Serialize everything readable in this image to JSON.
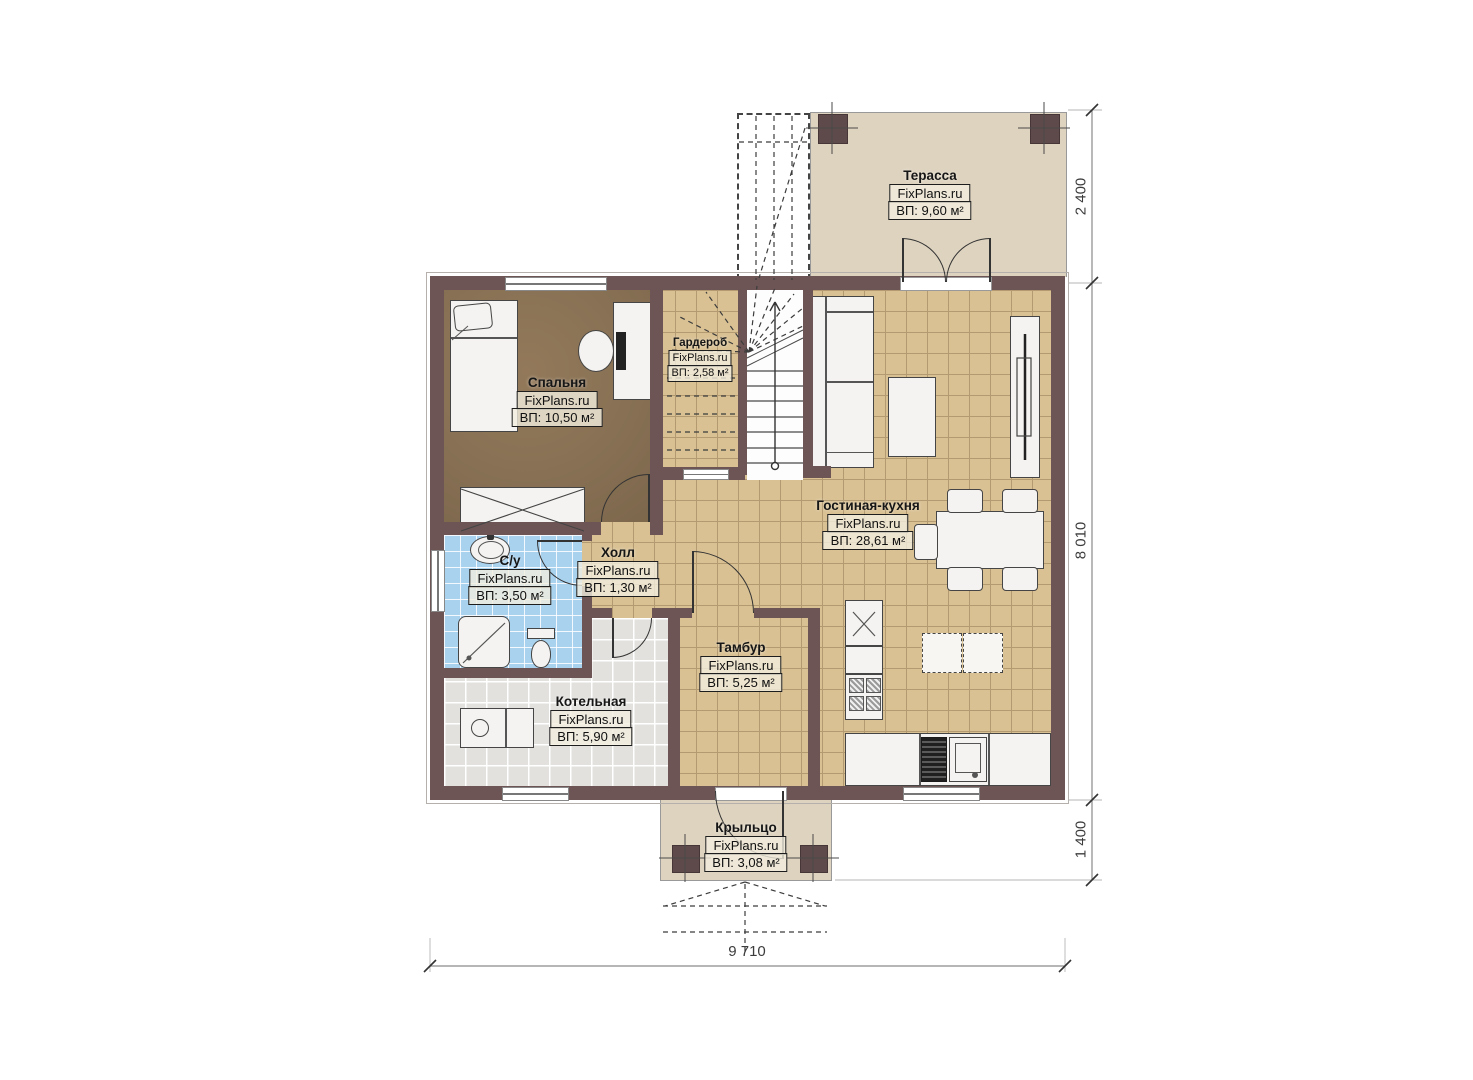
{
  "watermark": "FixPlans.ru",
  "rooms": {
    "terrace": {
      "name": "Терасса",
      "area": "ВП: 9,60 м²"
    },
    "bedroom": {
      "name": "Спальня",
      "area": "ВП: 10,50 м²"
    },
    "wardrobe": {
      "name": "Гардероб",
      "area": "ВП: 2,58 м²"
    },
    "living_kitchen": {
      "name": "Гостиная-кухня",
      "area": "ВП: 28,61 м²"
    },
    "hall": {
      "name": "Холл",
      "area": "ВП: 1,30 м²"
    },
    "bathroom": {
      "name": "С/у",
      "area": "ВП: 3,50 м²"
    },
    "boiler": {
      "name": "Котельная",
      "area": "ВП: 5,90 м²"
    },
    "tambour": {
      "name": "Тамбур",
      "area": "ВП: 5,25 м²"
    },
    "porch": {
      "name": "Крыльцо",
      "area": "ВП: 3,08 м²"
    }
  },
  "dimensions": {
    "terrace_depth": "2 400",
    "house_depth": "8 010",
    "porch_depth": "1 400",
    "house_width": "9 710"
  }
}
